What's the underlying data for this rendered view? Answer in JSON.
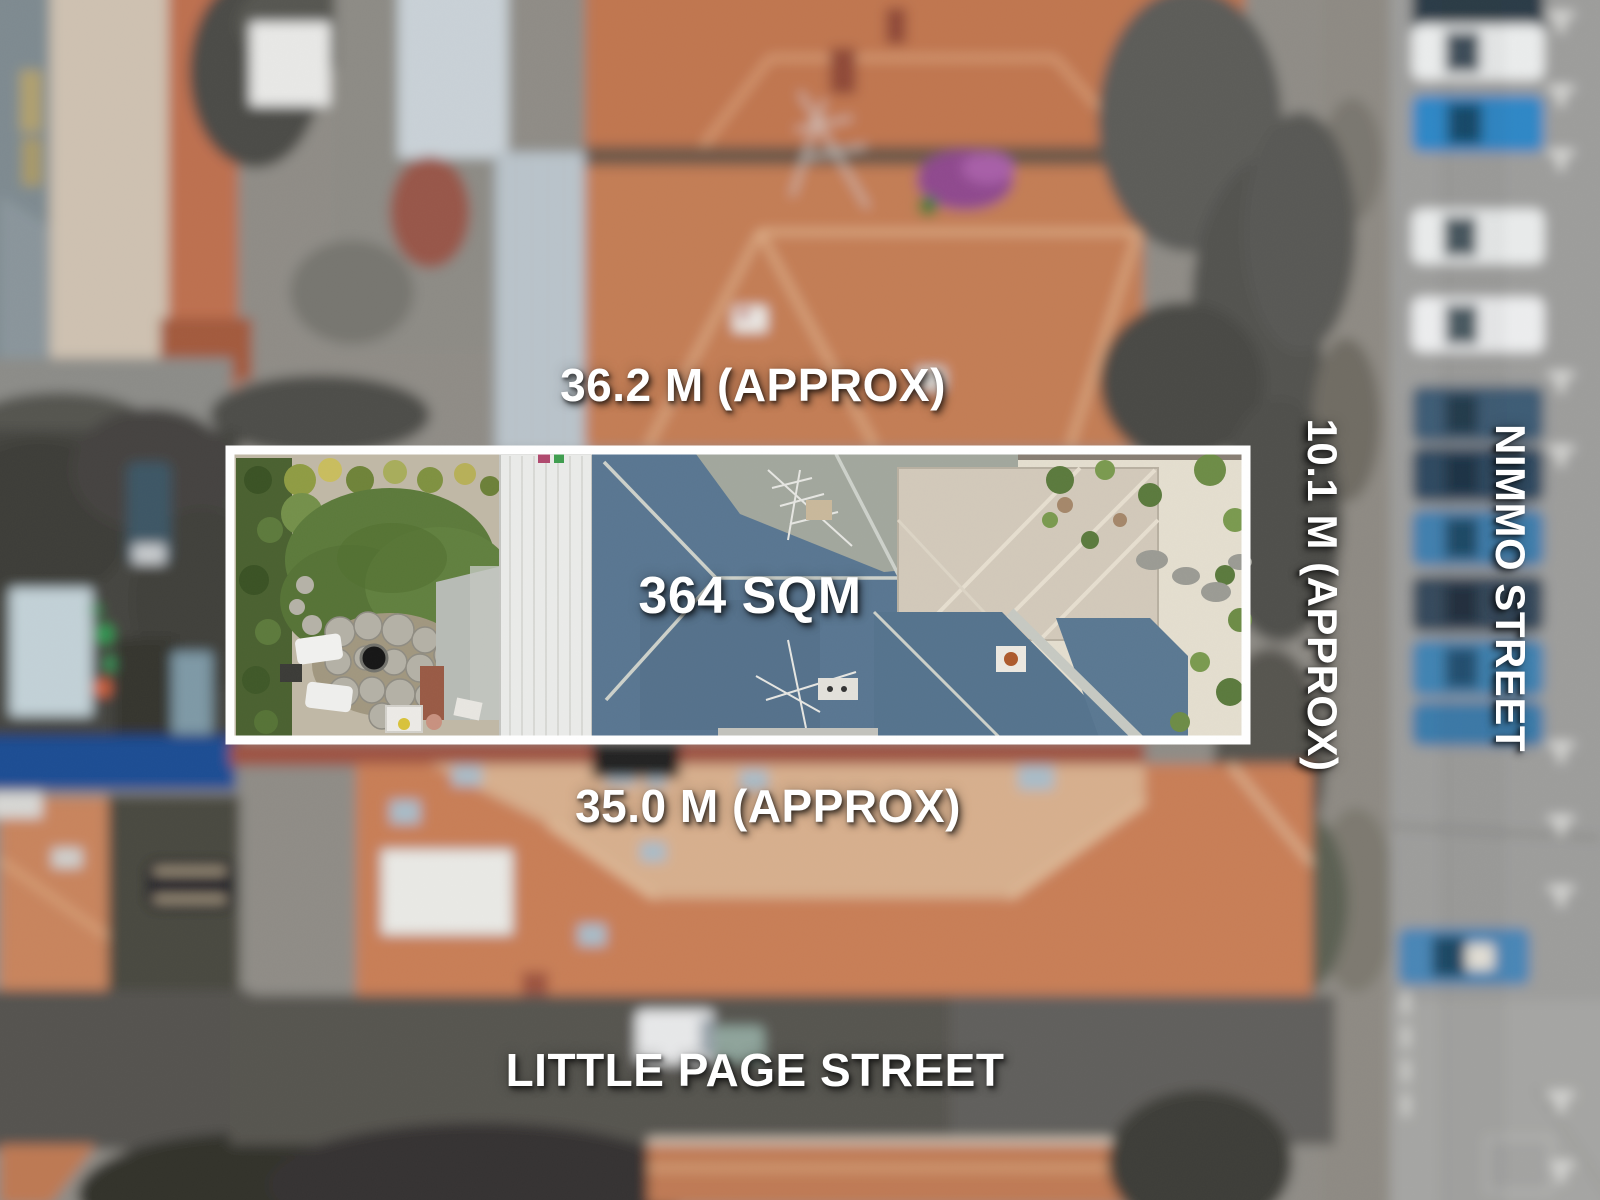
{
  "photo": {
    "annotations": {
      "top_boundary_length": "36.2 M (APPROX)",
      "land_area": "364 SQM",
      "right_boundary_length": "10.1 M (APPROX)",
      "bottom_boundary_length": "35.0 M (APPROX)"
    },
    "streets": {
      "bottom_street": "LITTLE PAGE STREET",
      "right_street": "NIMMO STREET"
    },
    "colors": {
      "annotation_text": "#ffffff",
      "boundary_outline": "#ffffff",
      "terracotta_roof": "#c57c55",
      "slate_roof": "#597691",
      "lawn_green": "#5c7a3b",
      "asphalt_road": "#57554f",
      "side_street_road": "#9d9d9b",
      "car_blue": "#2f87c6",
      "fence_blue": "#1b4e93"
    }
  }
}
